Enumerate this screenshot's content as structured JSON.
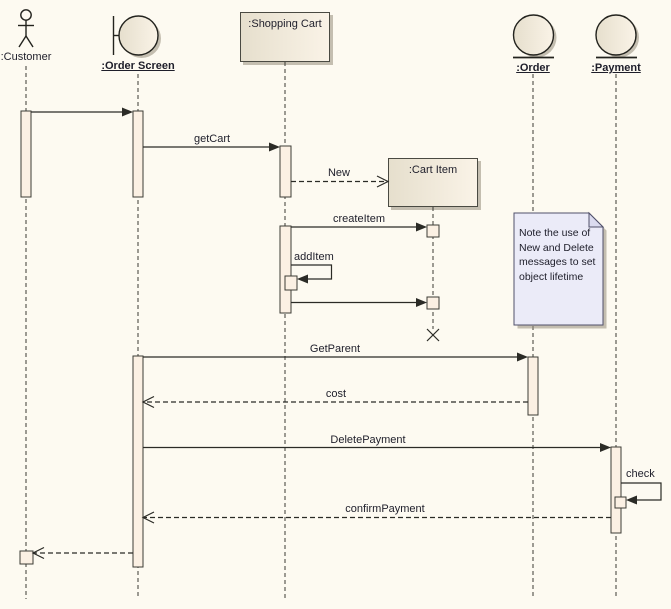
{
  "participants": {
    "customer": {
      "label": ":Customer",
      "kind": "actor"
    },
    "order_screen": {
      "label": ":Order Screen",
      "kind": "boundary"
    },
    "shopping_cart": {
      "label": ":Shopping Cart",
      "kind": "object"
    },
    "cart_item": {
      "label": ":Cart Item",
      "kind": "object"
    },
    "order": {
      "label": ":Order",
      "kind": "entity"
    },
    "payment": {
      "label": ":Payment",
      "kind": "entity"
    }
  },
  "messages": {
    "call_order_screen": {
      "label": "",
      "from": "customer",
      "to": "order_screen",
      "style": "solid"
    },
    "get_cart": {
      "label": "getCart",
      "from": "order_screen",
      "to": "shopping_cart",
      "style": "solid"
    },
    "new": {
      "label": "New",
      "from": "shopping_cart",
      "to": "cart_item",
      "style": "dashed"
    },
    "create_item": {
      "label": "createItem",
      "from": "shopping_cart",
      "to": "cart_item",
      "style": "solid"
    },
    "add_item": {
      "label": "addItem",
      "from": "shopping_cart",
      "to": "shopping_cart",
      "style": "self"
    },
    "delete": {
      "label": "",
      "from": "shopping_cart",
      "to": "cart_item",
      "style": "solid"
    },
    "get_parent": {
      "label": "GetParent",
      "from": "order_screen",
      "to": "order",
      "style": "solid"
    },
    "cost": {
      "label": "cost",
      "from": "order",
      "to": "order_screen",
      "style": "dashed"
    },
    "delete_payment": {
      "label": "DeletePayment",
      "from": "order_screen",
      "to": "payment",
      "style": "solid"
    },
    "check": {
      "label": "check",
      "from": "payment",
      "to": "payment",
      "style": "self"
    },
    "confirm_payment": {
      "label": "confirmPayment",
      "from": "payment",
      "to": "order_screen",
      "style": "dashed"
    },
    "return_to_customer": {
      "label": "",
      "from": "order_screen",
      "to": "customer",
      "style": "dashed"
    }
  },
  "note": {
    "text": "Note the use of\nNew and Delete\nmessages to set\nobject lifetime"
  },
  "colors": {
    "background": "#FDFAF1",
    "element_fill_dark": "#E6DFCD",
    "element_fill_light": "#FAF3E7",
    "activation_fill": "#FBF0E3",
    "note_fill": "#EBEBF8",
    "line": "#2B2B26",
    "text": "#1E1E2A"
  }
}
